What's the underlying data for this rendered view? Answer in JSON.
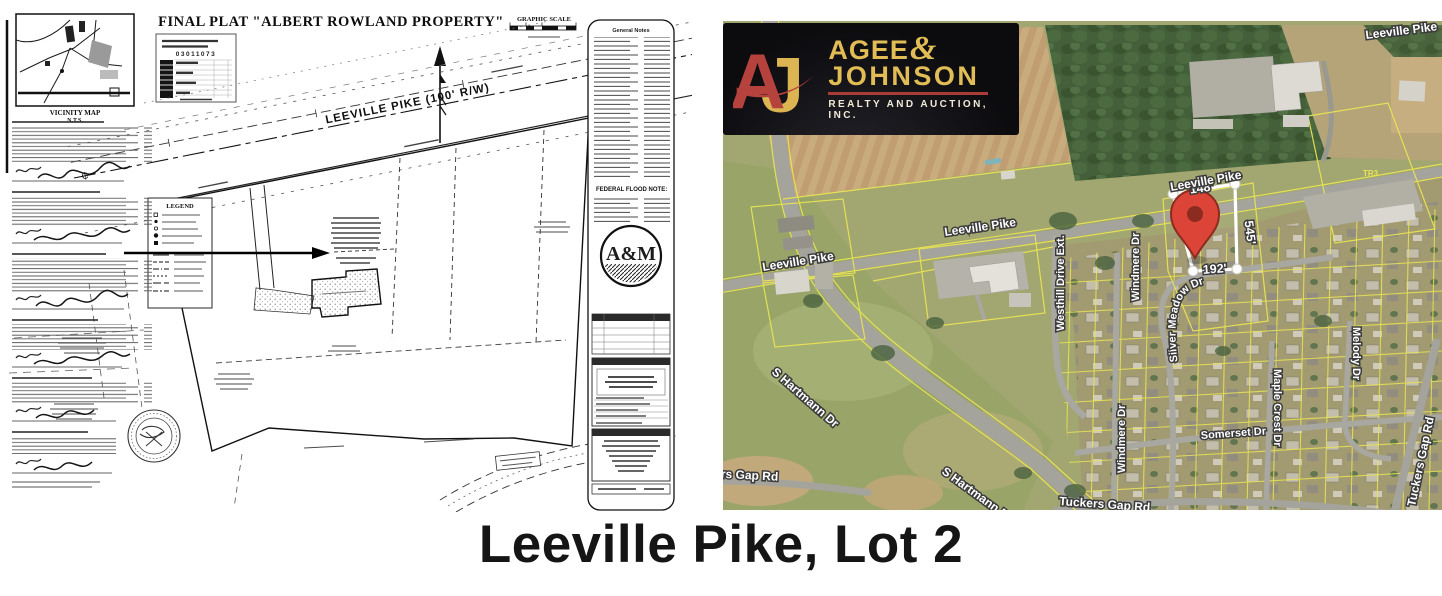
{
  "caption": "Leeville Pike, Lot 2",
  "logo": {
    "monogram_a": "A",
    "monogram_j": "J",
    "name_line1": "AGEE",
    "ampersand": "&",
    "name_line2": "JOHNSON",
    "tagline": "REALTY AND AUCTION, INC.",
    "gold": "#e2bd55",
    "red": "#b5423d",
    "black": "#0c0c0f"
  },
  "plat": {
    "title": "FINAL PLAT \"ALBERT ROWLAND PROPERTY\"",
    "graphic_scale_label": "GRAPHIC SCALE",
    "vicinity_map_label": "VICINITY MAP",
    "vicinity_map_scale": "N.T.S.",
    "road_label": "LEEVILLE PIKE (100' R/W)",
    "legend_label": "LEGEND",
    "flood_note_label": "FEDERAL FLOOD NOTE:",
    "notes_header": "General Notes",
    "stamp_number": "03011073",
    "seal_monogram": "A&M",
    "centerline_symbol": "₵"
  },
  "map": {
    "parcel_tag": "TR3",
    "streets": [
      "Leeville Pike",
      "Leeville Pike",
      "Leeville Pike",
      "Leeville Pike",
      "Westhill Drive Ext.",
      "Windmere Dr",
      "Windmere Dr",
      "Silver Meadow Dr",
      "Somerset Dr",
      "Maple Crest Dr",
      "Melody Dr",
      "S Hartmann Dr",
      "S Hartmann Dr",
      "Tuckers Gap Rd",
      "Tuckers Gap Rd",
      "Tuckers Gap Rd"
    ],
    "lot_dimensions": {
      "front": "148'",
      "side_right": "545'",
      "side_left": "545'",
      "rear": "192'"
    },
    "pin_color": "#db4437",
    "parcel_line_color": "#e8e455"
  }
}
